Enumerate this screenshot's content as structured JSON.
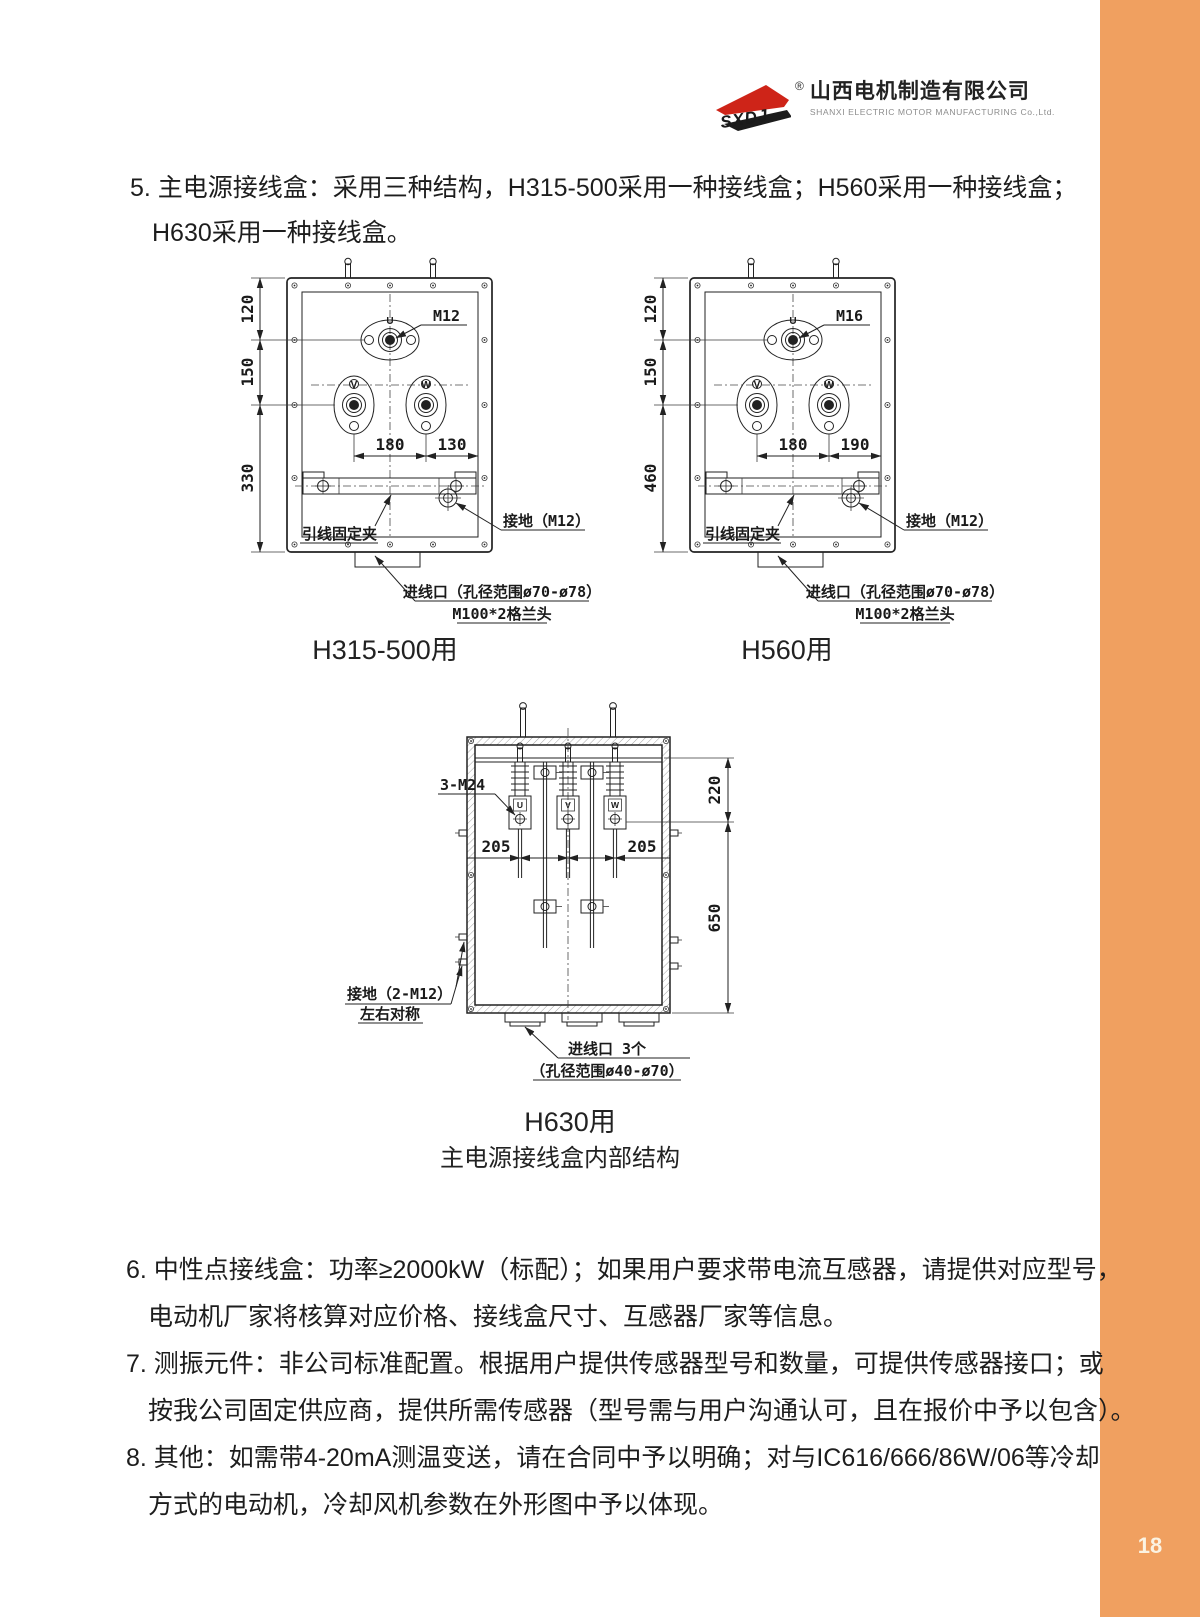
{
  "page": {
    "number": "18"
  },
  "header": {
    "logo_abbr": "SXDJ",
    "logo_reg": "®",
    "company_cn": "山西电机制造有限公司",
    "company_en": "SHANXI ELECTRIC MOTOR MANUFACTURING Co.,Ltd."
  },
  "section5": {
    "line1": "5. 主电源接线盒：采用三种结构，H315-500采用一种接线盒；H560采用一种接线盒；",
    "line2": "H630采用一种接线盒。"
  },
  "diagram1": {
    "caption": "H315-500用",
    "terminal_u": "U",
    "terminal_v": "V",
    "terminal_w": "W",
    "bolt_label": "M12",
    "dim_top": "120",
    "dim_mid": "150",
    "dim_bottom": "330",
    "dim_vw": "180",
    "dim_wr": "130",
    "clamp_label": "引线固定夹",
    "ground_label": "接地（M12）",
    "entry_line1": "进线口（孔径范围ø70-ø78）",
    "entry_line2": "M100*2格兰头"
  },
  "diagram2": {
    "caption": "H560用",
    "terminal_u": "U",
    "terminal_v": "V",
    "terminal_w": "W",
    "bolt_label": "M16",
    "dim_top": "120",
    "dim_mid": "150",
    "dim_bottom": "460",
    "dim_vw": "180",
    "dim_wr": "190",
    "clamp_label": "引线固定夹",
    "ground_label": "接地（M12）",
    "entry_line1": "进线口（孔径范围ø70-ø78）",
    "entry_line2": "M100*2格兰头"
  },
  "diagram3": {
    "caption": "H630用",
    "terminal_u": "U",
    "terminal_v": "V",
    "terminal_w": "W",
    "bolt_label": "3-M24",
    "dim_uv": "205",
    "dim_vw": "205",
    "dim_upper": "220",
    "dim_lower": "650",
    "ground_line1": "接地（2-M12）",
    "ground_line2": "左右对称",
    "entry_line1": "进线口 3个",
    "entry_line2": "（孔径范围ø40-ø70）"
  },
  "figure_subtitle": "主电源接线盒内部结构",
  "notes": {
    "n6a": "6. 中性点接线盒：功率≥2000kW（标配）；如果用户要求带电流互感器，请提供对应型号，",
    "n6b": "电动机厂家将核算对应价格、接线盒尺寸、互感器厂家等信息。",
    "n7a": "7. 测振元件：非公司标准配置。根据用户提供传感器型号和数量，可提供传感器接口；或",
    "n7b": "按我公司固定供应商，提供所需传感器（型号需与用户沟通认可，且在报价中予以包含）。",
    "n8a": "8. 其他：如需带4-20mA测温变送，请在合同中予以明确；对与IC616/666/86W/06等冷却",
    "n8b": "方式的电动机，冷却风机参数在外形图中予以体现。"
  }
}
